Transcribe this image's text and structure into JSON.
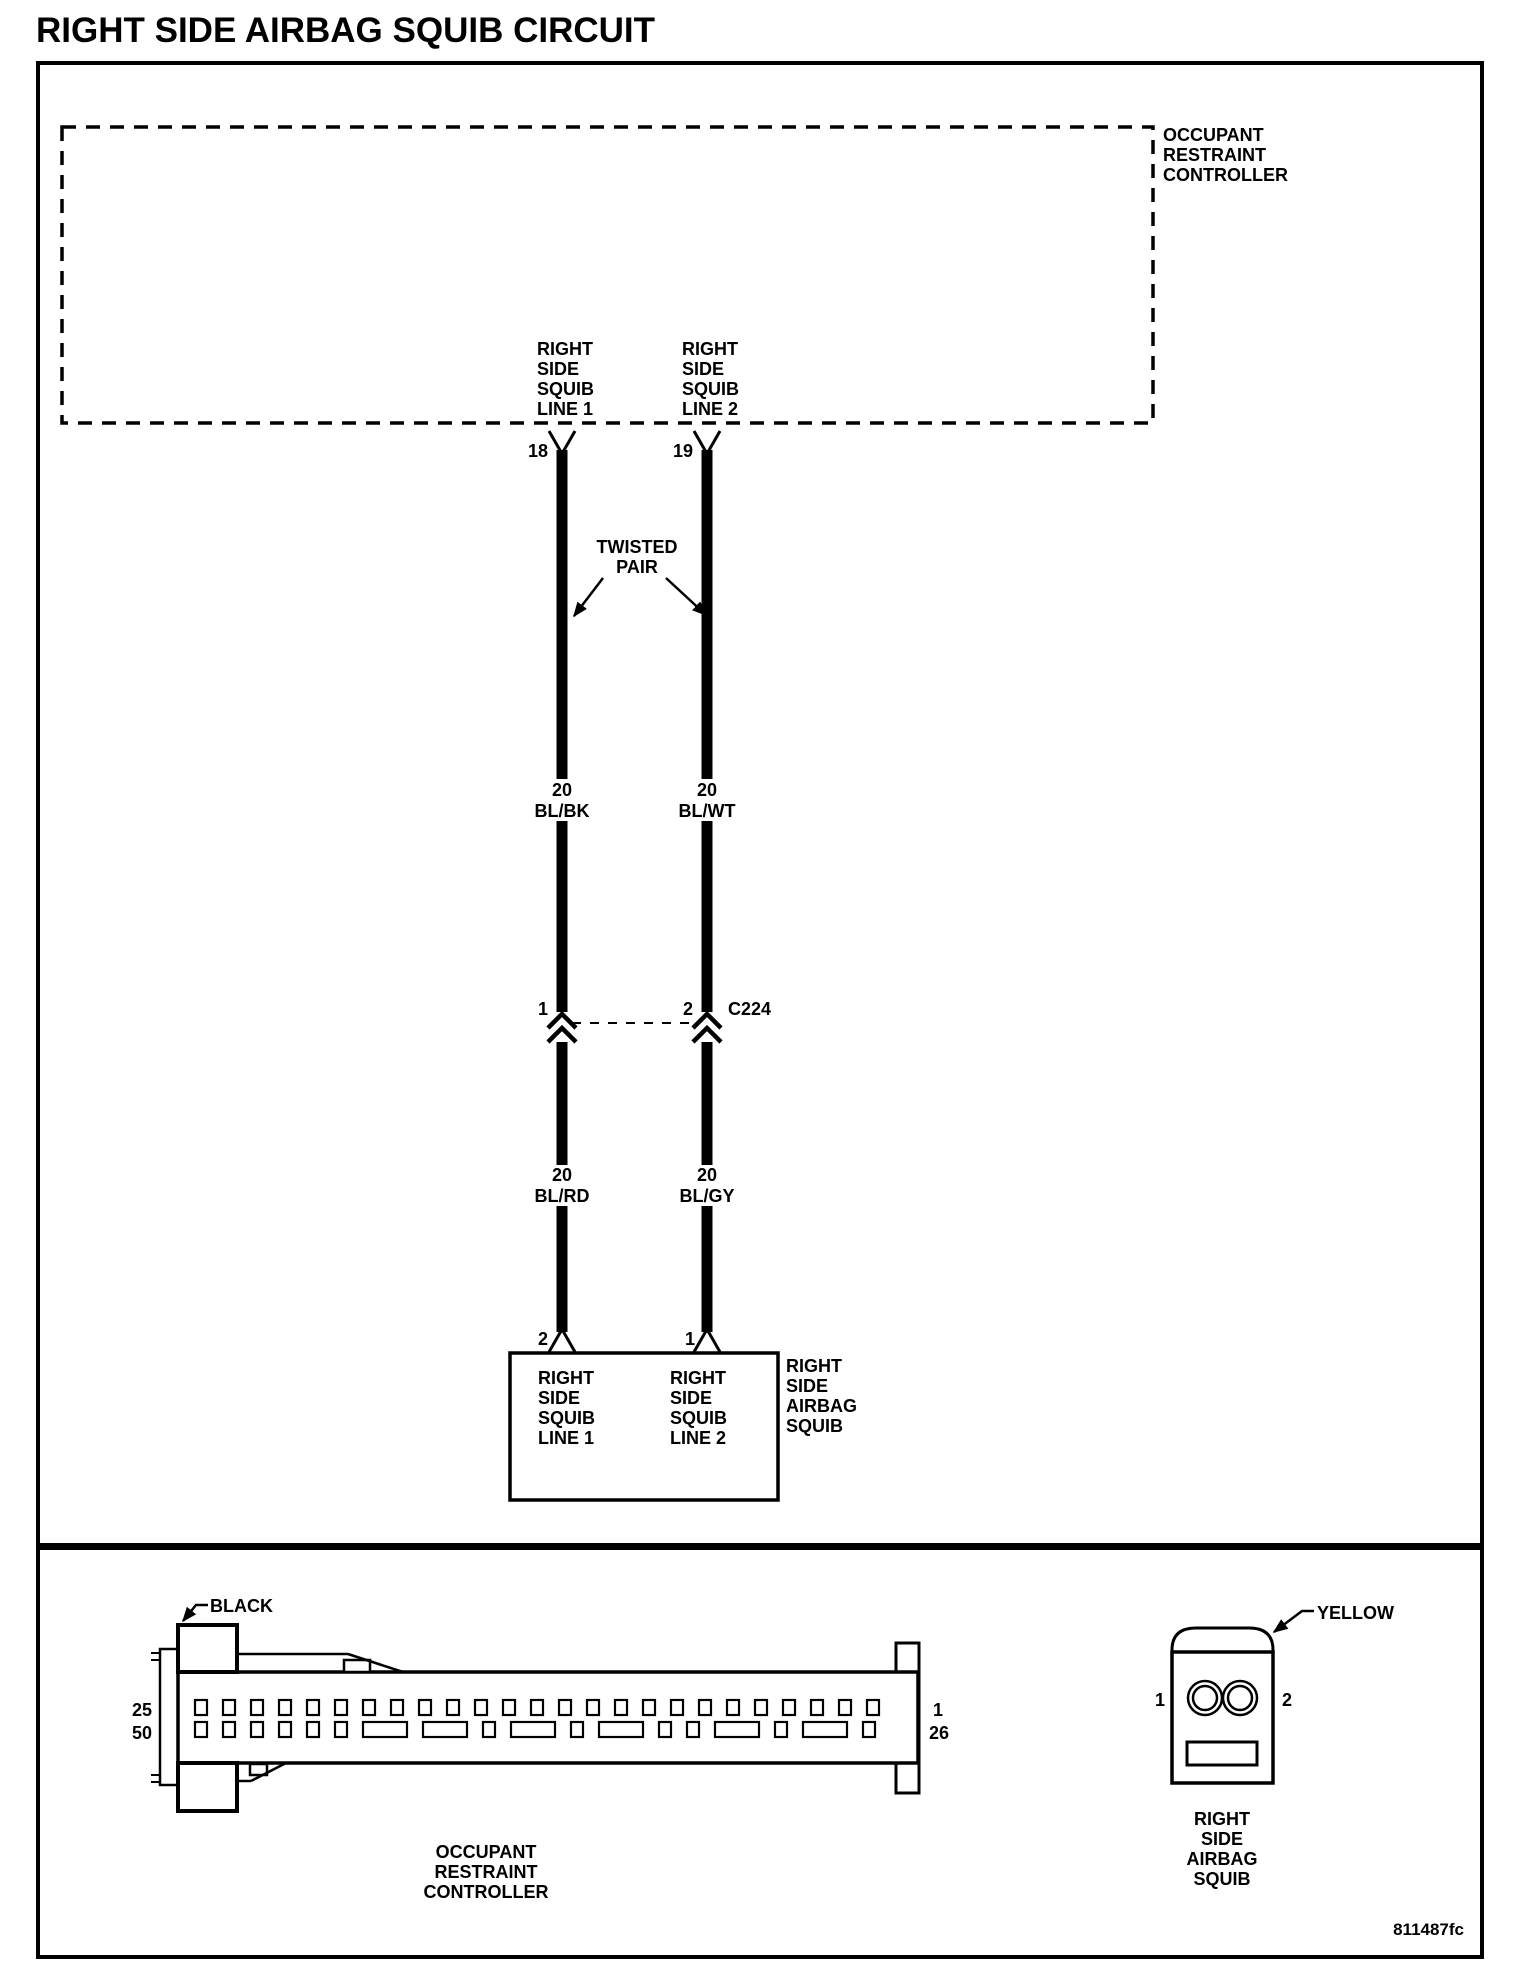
{
  "title": "RIGHT SIDE AIRBAG SQUIB CIRCUIT",
  "diagram_code": "811487fc",
  "colors": {
    "line": "#000000",
    "background": "#ffffff"
  },
  "schematic": {
    "controller_label": [
      "OCCUPANT",
      "RESTRAINT",
      "CONTROLLER"
    ],
    "line1_label": [
      "RIGHT",
      "SIDE",
      "SQUIB",
      "LINE 1"
    ],
    "line2_label": [
      "RIGHT",
      "SIDE",
      "SQUIB",
      "LINE 2"
    ],
    "pin_18": "18",
    "pin_19": "19",
    "twisted_pair_label": [
      "TWISTED",
      "PAIR"
    ],
    "wire1_upper_gauge": "20",
    "wire1_upper_color": "BL/BK",
    "wire2_upper_gauge": "20",
    "wire2_upper_color": "BL/WT",
    "connector_c224": {
      "pin_1": "1",
      "pin_2": "2",
      "label": "C224"
    },
    "wire1_lower_gauge": "20",
    "wire1_lower_color": "BL/RD",
    "wire2_lower_gauge": "20",
    "wire2_lower_color": "BL/GY",
    "squib_pin_2": "2",
    "squib_pin_1": "1",
    "squib_line1_label": [
      "RIGHT",
      "SIDE",
      "SQUIB",
      "LINE 1"
    ],
    "squib_line2_label": [
      "RIGHT",
      "SIDE",
      "SQUIB",
      "LINE 2"
    ],
    "squib_component_label": [
      "RIGHT",
      "SIDE",
      "AIRBAG",
      "SQUIB"
    ]
  },
  "connectors": {
    "orc": {
      "color": "BLACK",
      "pin_top_left": "25",
      "pin_bottom_left": "50",
      "pin_top_right": "1",
      "pin_bottom_right": "26",
      "caption": [
        "OCCUPANT",
        "RESTRAINT",
        "CONTROLLER"
      ],
      "top_row_pins": 25,
      "bottom_row_pattern": [
        "s",
        "s",
        "s",
        "s",
        "s",
        "s",
        "w",
        "w",
        "s",
        "w",
        "s",
        "w",
        "s",
        "s",
        "w",
        "s",
        "w",
        "s"
      ]
    },
    "airbag_squib": {
      "color": "YELLOW",
      "pin_left": "1",
      "pin_right": "2",
      "caption": [
        "RIGHT",
        "SIDE",
        "AIRBAG",
        "SQUIB"
      ]
    }
  }
}
